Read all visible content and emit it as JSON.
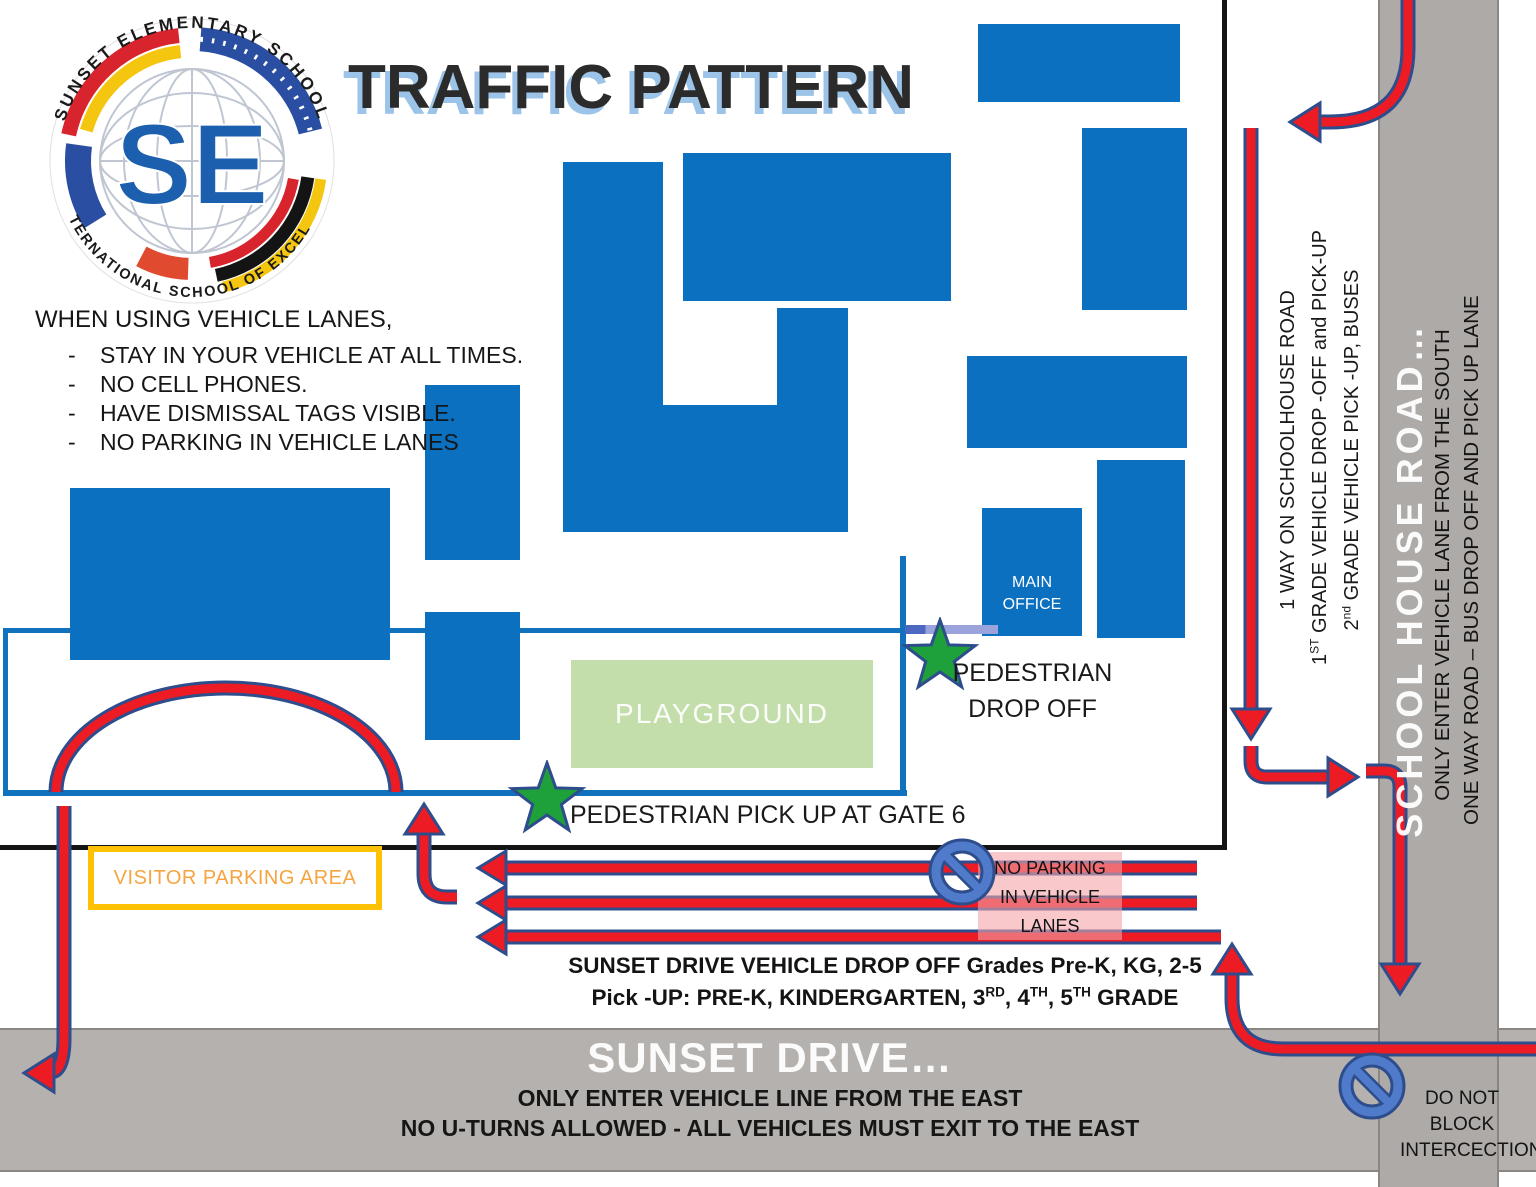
{
  "title": "TRAFFIC PATTERN",
  "logo": {
    "arc_top": "SUNSET ELEMENTARY SCHOOL",
    "arc_bottom": "AN INTERNATIONAL SCHOOL OF EXCELLENCE",
    "monogram": "SE"
  },
  "rules": {
    "heading": "WHEN USING VEHICLE LANES,",
    "dash": "-",
    "items": [
      "STAY IN YOUR VEHICLE AT ALL TIMES.",
      "NO CELL PHONES.",
      "HAVE DISMISSAL TAGS VISIBLE.",
      "NO PARKING IN VEHICLE LANES"
    ]
  },
  "campus": {
    "playground": "PLAYGROUND",
    "main_office_lines": [
      "MAIN",
      "OFFICE"
    ],
    "pedestrian_drop_off_lines": [
      "PEDESTRIAN",
      "DROP OFF"
    ],
    "pedestrian_pick_up": "PEDESTRIAN PICK UP AT GATE 6",
    "visitor_parking": "VISITOR PARKING AREA"
  },
  "schoolhouse_notes": {
    "one_way": "1 WAY ON SCHOOLHOUSE ROAD",
    "grade1": [
      {
        "t": "1"
      },
      {
        "t": "ST",
        "sup": true
      },
      {
        "t": " GRADE VEHICLE DROP -OFF and PICK-UP"
      }
    ],
    "grade2": [
      {
        "t": "2"
      },
      {
        "t": "nd",
        "sup": true
      },
      {
        "t": " GRADE VEHICLE PICK -UP, BUSES"
      }
    ]
  },
  "school_house_road": {
    "name": "SCHOOL HOUSE ROAD…",
    "line1": "ONLY ENTER VEHICLE LANE FROM THE SOUTH",
    "line2": "ONE WAY ROAD – BUS DROP OFF AND PICK UP LANE"
  },
  "sunset_drive": {
    "name": "SUNSET DRIVE…",
    "line1": "ONLY ENTER VEHICLE LINE FROM THE EAST",
    "line2": "NO U-TURNS ALLOWED - ALL VEHICLES MUST EXIT TO THE EAST"
  },
  "sunset_note": {
    "line1": "SUNSET DRIVE VEHICLE DROP OFF Grades Pre-K, KG, 2-5",
    "line2": [
      {
        "t": "Pick -UP: PRE-K, KINDERGARTEN, 3"
      },
      {
        "t": "RD",
        "sup": true
      },
      {
        "t": ", 4"
      },
      {
        "t": "TH",
        "sup": true
      },
      {
        "t": ", 5"
      },
      {
        "t": "TH",
        "sup": true
      },
      {
        "t": " GRADE"
      }
    ]
  },
  "no_parking": {
    "lines": [
      "NO PARKING",
      "IN VEHICLE",
      "LANES"
    ]
  },
  "do_not_block": {
    "lines": [
      "DO NOT BLOCK",
      "INTERCECTION"
    ]
  },
  "colors": {
    "building_blue": "#0b70c0",
    "road_gray": "#b1adaa",
    "arrow_red": "#ec1b24",
    "arrow_outline": "#2e4d8c",
    "playground_green": "#c3ddab",
    "star_green": "#1ea13b",
    "visitor_border": "#ffc104",
    "visitor_text": "#f7a440",
    "title_shadow": "#9cc3e8",
    "no_parking_icon_blue": "#4f7bca",
    "gate_lavender": "#9aa3dc"
  }
}
